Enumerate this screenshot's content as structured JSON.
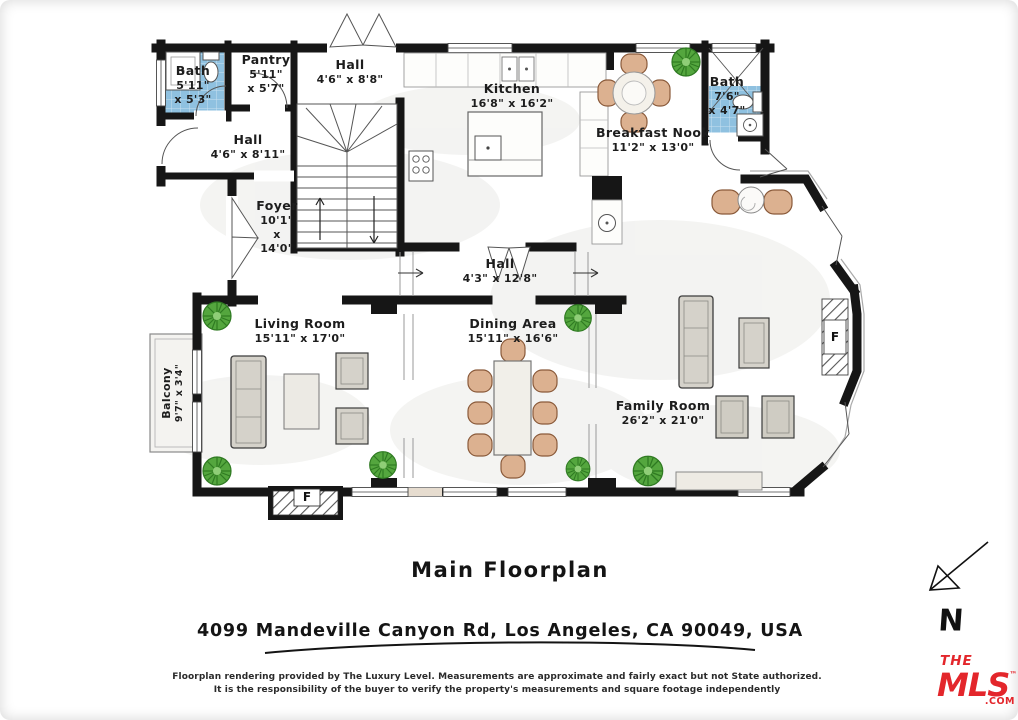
{
  "title": "Main Floorplan",
  "address": "4099 Mandeville Canyon Rd, Los Angeles, CA 90049, USA",
  "disclaimer": {
    "line1": "Floorplan rendering provided by The Luxury Level. Measurements are approximate and fairly exact but not State authorized.",
    "line2": "It is the responsibility of the buyer to verify the property's measurements and square footage independently"
  },
  "compass": {
    "label": "N"
  },
  "logo": {
    "line1": "THE",
    "line2": "MLS",
    "tm": "™",
    "suffix": ".COM",
    "color": "#E3262B"
  },
  "fireplace": {
    "label": "F"
  },
  "colors": {
    "wall": "#161616",
    "tile_blue": "#8fc1e0",
    "plant_green": "#54a63e",
    "furniture_tan": "#dcb190",
    "furniture_gray": "#d5d2ca"
  },
  "rooms": {
    "bath_left": {
      "name": "Bath",
      "dim1": "5'11\"",
      "dim2": "x 5'3\""
    },
    "pantry": {
      "name": "Pantry",
      "dim1": "5'11\"",
      "dim2": "x 5'7\""
    },
    "hall_top": {
      "name": "Hall",
      "dim1": "4'6\" x 8'8\""
    },
    "kitchen": {
      "name": "Kitchen",
      "dim1": "16'8\" x 16'2\""
    },
    "breakfast_nook": {
      "name": "Breakfast Nook",
      "dim1": "11'2\" x 13'0\""
    },
    "bath_right": {
      "name": "Bath",
      "dim1": "7'6\"",
      "dim2": "x 4'7\""
    },
    "hall_left": {
      "name": "Hall",
      "dim1": "4'6\" x 8'11\""
    },
    "foyer": {
      "name": "Foyer",
      "dim1": "10'1\"",
      "dim2": "x",
      "dim3": "14'0\""
    },
    "hall_center": {
      "name": "Hall",
      "dim1": "4'3\" x 12'8\""
    },
    "living_room": {
      "name": "Living Room",
      "dim1": "15'11\" x 17'0\""
    },
    "dining_area": {
      "name": "Dining Area",
      "dim1": "15'11\" x 16'6\""
    },
    "family_room": {
      "name": "Family Room",
      "dim1": "26'2\" x 21'0\""
    },
    "balcony": {
      "name": "Balcony",
      "dim1": "9'7\" x 3'4\""
    }
  }
}
